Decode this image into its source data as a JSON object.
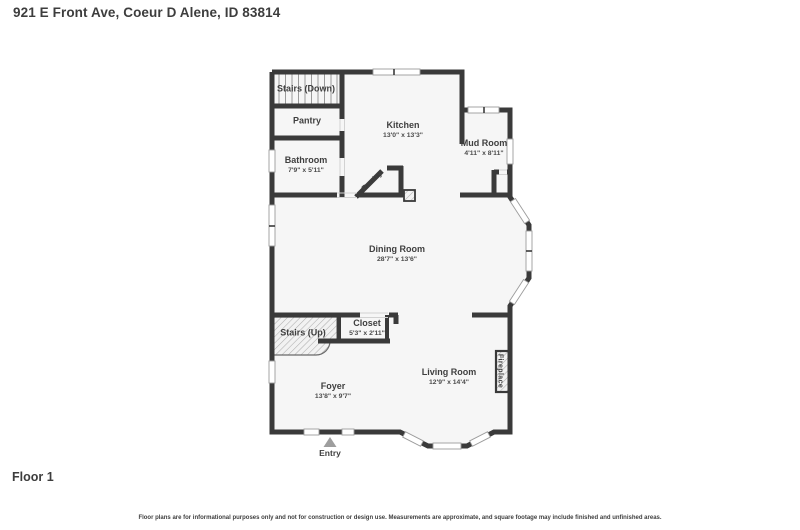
{
  "header": {
    "title": "921 E Front Ave, Coeur D Alene, ID 83814"
  },
  "floor_label": "Floor 1",
  "disclaimer": "Floor plans are for informational purposes only and not for construction or design use. Measurements are approximate, and square footage may include finished and unfinished areas.",
  "plan": {
    "entry_label": "Entry",
    "rooms": {
      "stairs_down": {
        "name": "Stairs (Down)"
      },
      "pantry_room": {
        "name": "Pantry"
      },
      "kitchen": {
        "name": "Kitchen",
        "dims": "13'0\" x 13'3\""
      },
      "mud_room": {
        "name": "Mud Room",
        "dims": "4'11\" x 8'11\""
      },
      "bathroom": {
        "name": "Bathroom",
        "dims": "7'9\" x 5'11\""
      },
      "corner_pantry": {
        "name": "Pantry"
      },
      "dining_room": {
        "name": "Dining Room",
        "dims": "28'7\" x 13'6\""
      },
      "stairs_up": {
        "name": "Stairs (Up)"
      },
      "closet": {
        "name": "Closet",
        "dims": "5'3\" x 2'11\""
      },
      "living_room": {
        "name": "Living Room",
        "dims": "12'9\" x 14'4\""
      },
      "fireplace": {
        "name": "Fireplace"
      },
      "foyer": {
        "name": "Foyer",
        "dims": "13'8\" x 9'7\""
      }
    },
    "colors": {
      "wall": "#3a3a3a",
      "floor_fill": "#f6f6f6",
      "text": "#3f3f3f",
      "entry_marker": "#9e9e9e"
    }
  }
}
